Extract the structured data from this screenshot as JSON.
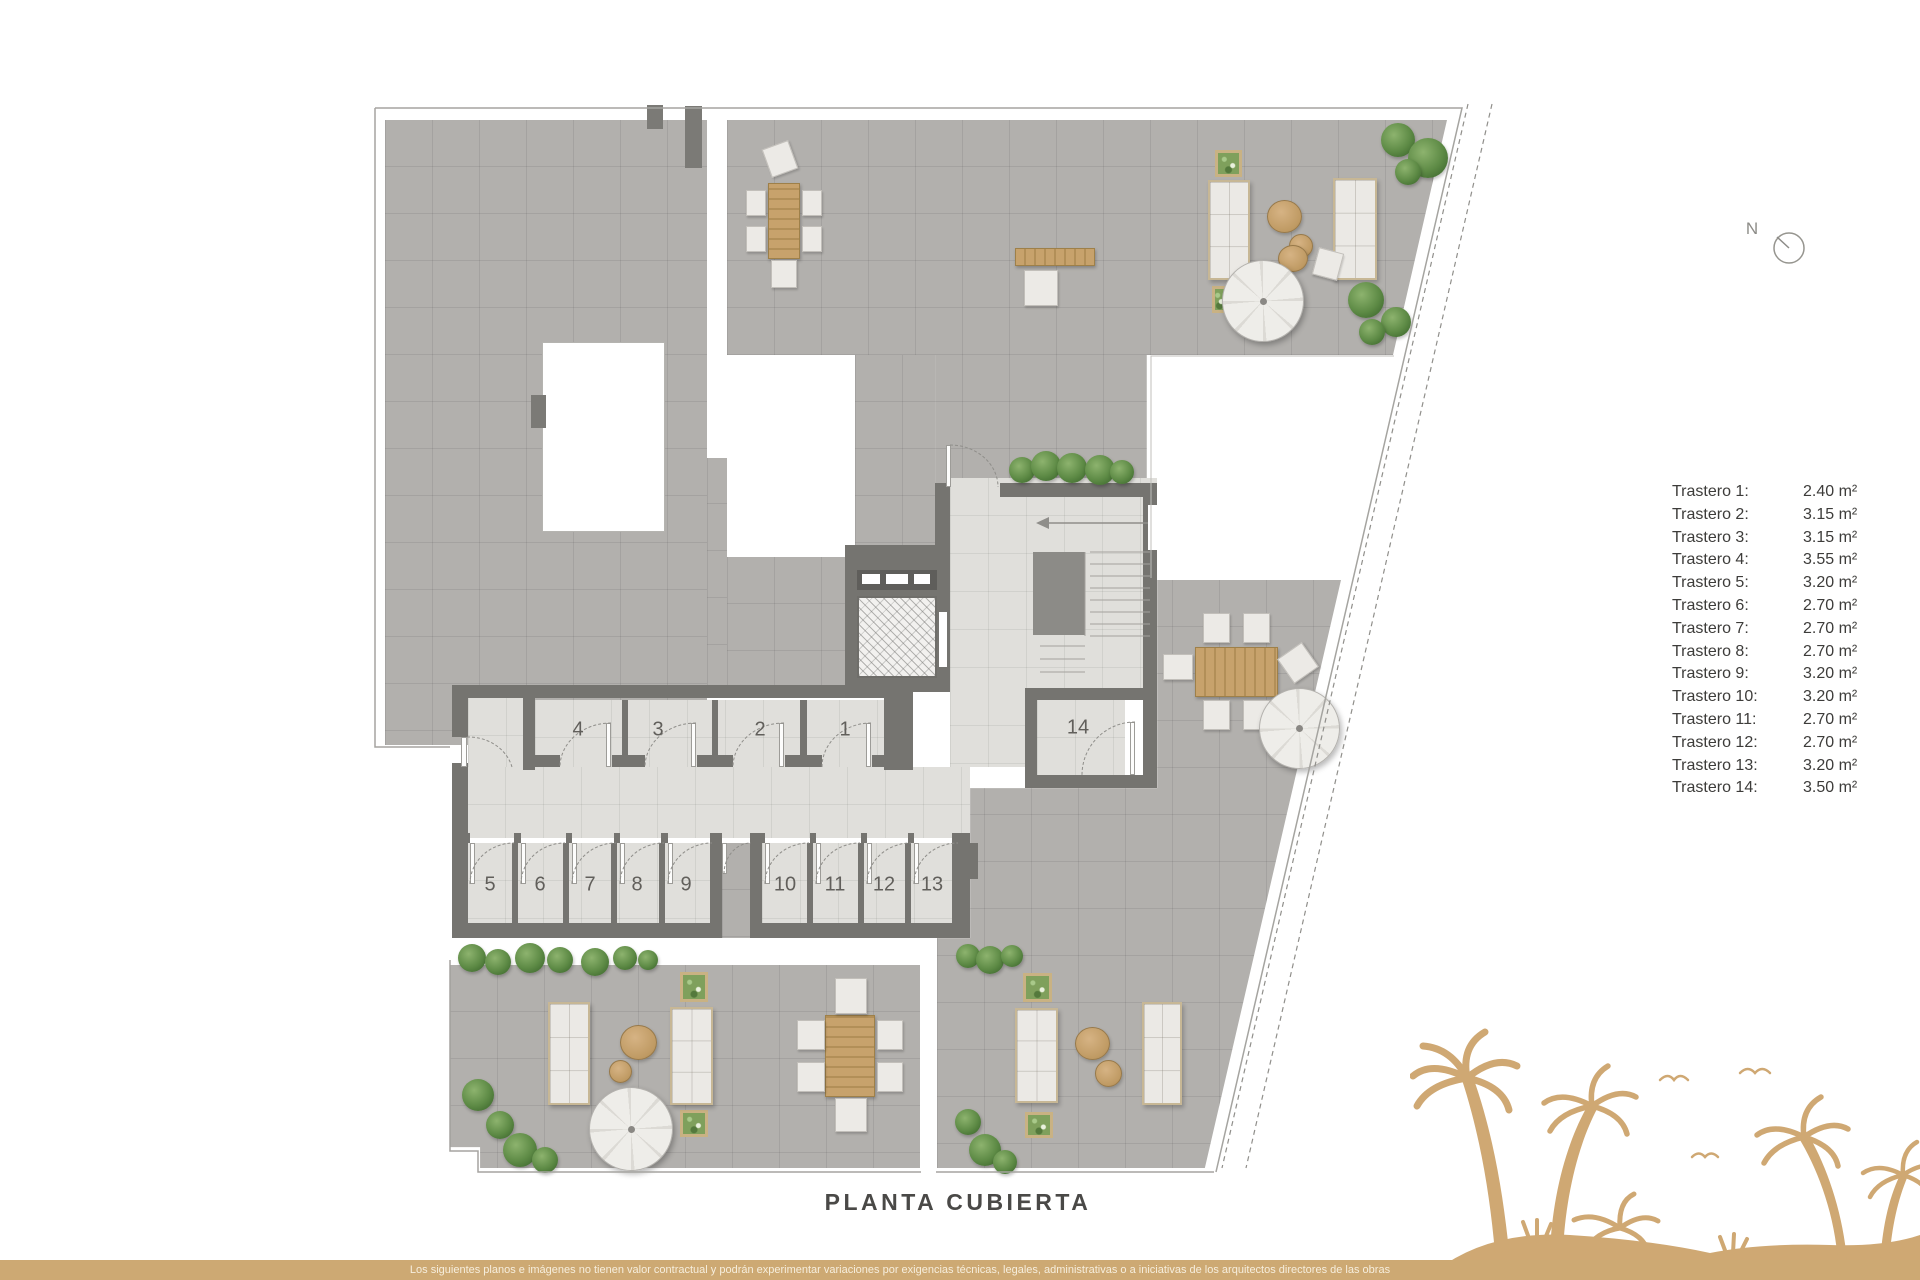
{
  "title": "PLANTA CUBIERTA",
  "compass": {
    "label": "N"
  },
  "legend": {
    "items": [
      {
        "label": "Trastero 1:",
        "value": "2.40 m²"
      },
      {
        "label": "Trastero 2:",
        "value": "3.15 m²"
      },
      {
        "label": "Trastero 3:",
        "value": "3.15 m²"
      },
      {
        "label": "Trastero 4:",
        "value": "3.55 m²"
      },
      {
        "label": "Trastero 5:",
        "value": "3.20 m²"
      },
      {
        "label": "Trastero 6:",
        "value": "2.70 m²"
      },
      {
        "label": "Trastero 7:",
        "value": "2.70 m²"
      },
      {
        "label": "Trastero 8:",
        "value": "2.70 m²"
      },
      {
        "label": "Trastero 9:",
        "value": "3.20 m²"
      },
      {
        "label": "Trastero 10:",
        "value": "3.20 m²"
      },
      {
        "label": "Trastero 11:",
        "value": "2.70 m²"
      },
      {
        "label": "Trastero 12:",
        "value": "2.70 m²"
      },
      {
        "label": "Trastero 13:",
        "value": "3.20 m²"
      },
      {
        "label": "Trastero 14:",
        "value": "3.50 m²"
      }
    ]
  },
  "rooms": {
    "numbers": [
      "1",
      "2",
      "3",
      "4",
      "5",
      "6",
      "7",
      "8",
      "9",
      "10",
      "11",
      "12",
      "13",
      "14"
    ]
  },
  "footer": {
    "disclaimer": "Los siguientes planos e imágenes no tienen valor contractual y podrán experimentar variaciones por exigencias técnicas, legales, administrativas o a iniciativas de los arquitectos directores de las obras"
  },
  "colors": {
    "accent_tan": "#cda973",
    "wall_gray": "#757470",
    "terrace_tile": "#b2b0ad",
    "interior_tile": "#e0dfdb",
    "plant_green": "#5d8a45"
  }
}
